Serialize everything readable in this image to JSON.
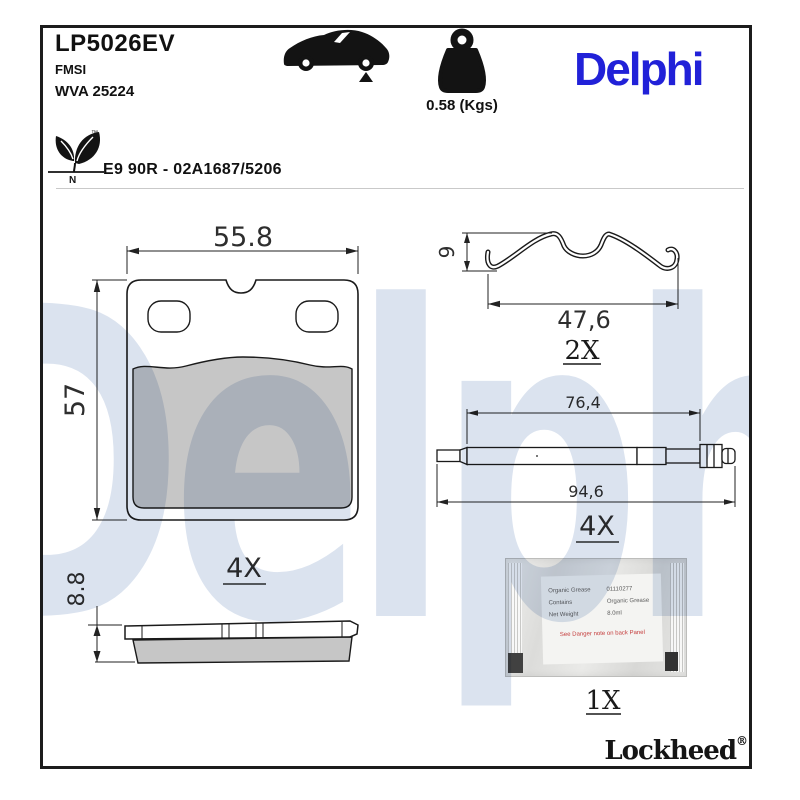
{
  "header": {
    "part_number": "LP5026EV",
    "fmsi_label": "FMSI",
    "wva_number": "WVA 25224",
    "weight": "0.58 (Kgs)",
    "brand": "Delphi",
    "approval": "E9 90R - 02A1687/5206",
    "eco_mark_letter": "N",
    "trademark_symbol": "™"
  },
  "drawings": {
    "pad_front": {
      "width_dim": "55.8",
      "height_dim": "57",
      "quantity": "4X"
    },
    "spring_clip": {
      "height_dim": "9",
      "width_dim": "47,6",
      "quantity": "2X"
    },
    "pin": {
      "inner_dim": "76,4",
      "overall_dim": "94,6",
      "quantity": "4X"
    },
    "pad_side": {
      "thickness_dim": "8.8"
    },
    "grease_sachet": {
      "quantity": "1X",
      "label_rows": [
        {
          "key": "Organic Grease",
          "value": "01110277"
        },
        {
          "key": "Contains",
          "value": "Organic Grease"
        },
        {
          "key": "Net Weight",
          "value": "8.0ml"
        }
      ],
      "warning": "See Danger note on back Panel"
    }
  },
  "watermark": "Delphi",
  "footer": {
    "brand": "Lockheed",
    "registered": "®"
  },
  "colors": {
    "brand_blue": "#2121d8",
    "watermark_blue": "#dbe3ef",
    "friction_gray": "#c6c6c6",
    "line": "#1a1a1a"
  }
}
